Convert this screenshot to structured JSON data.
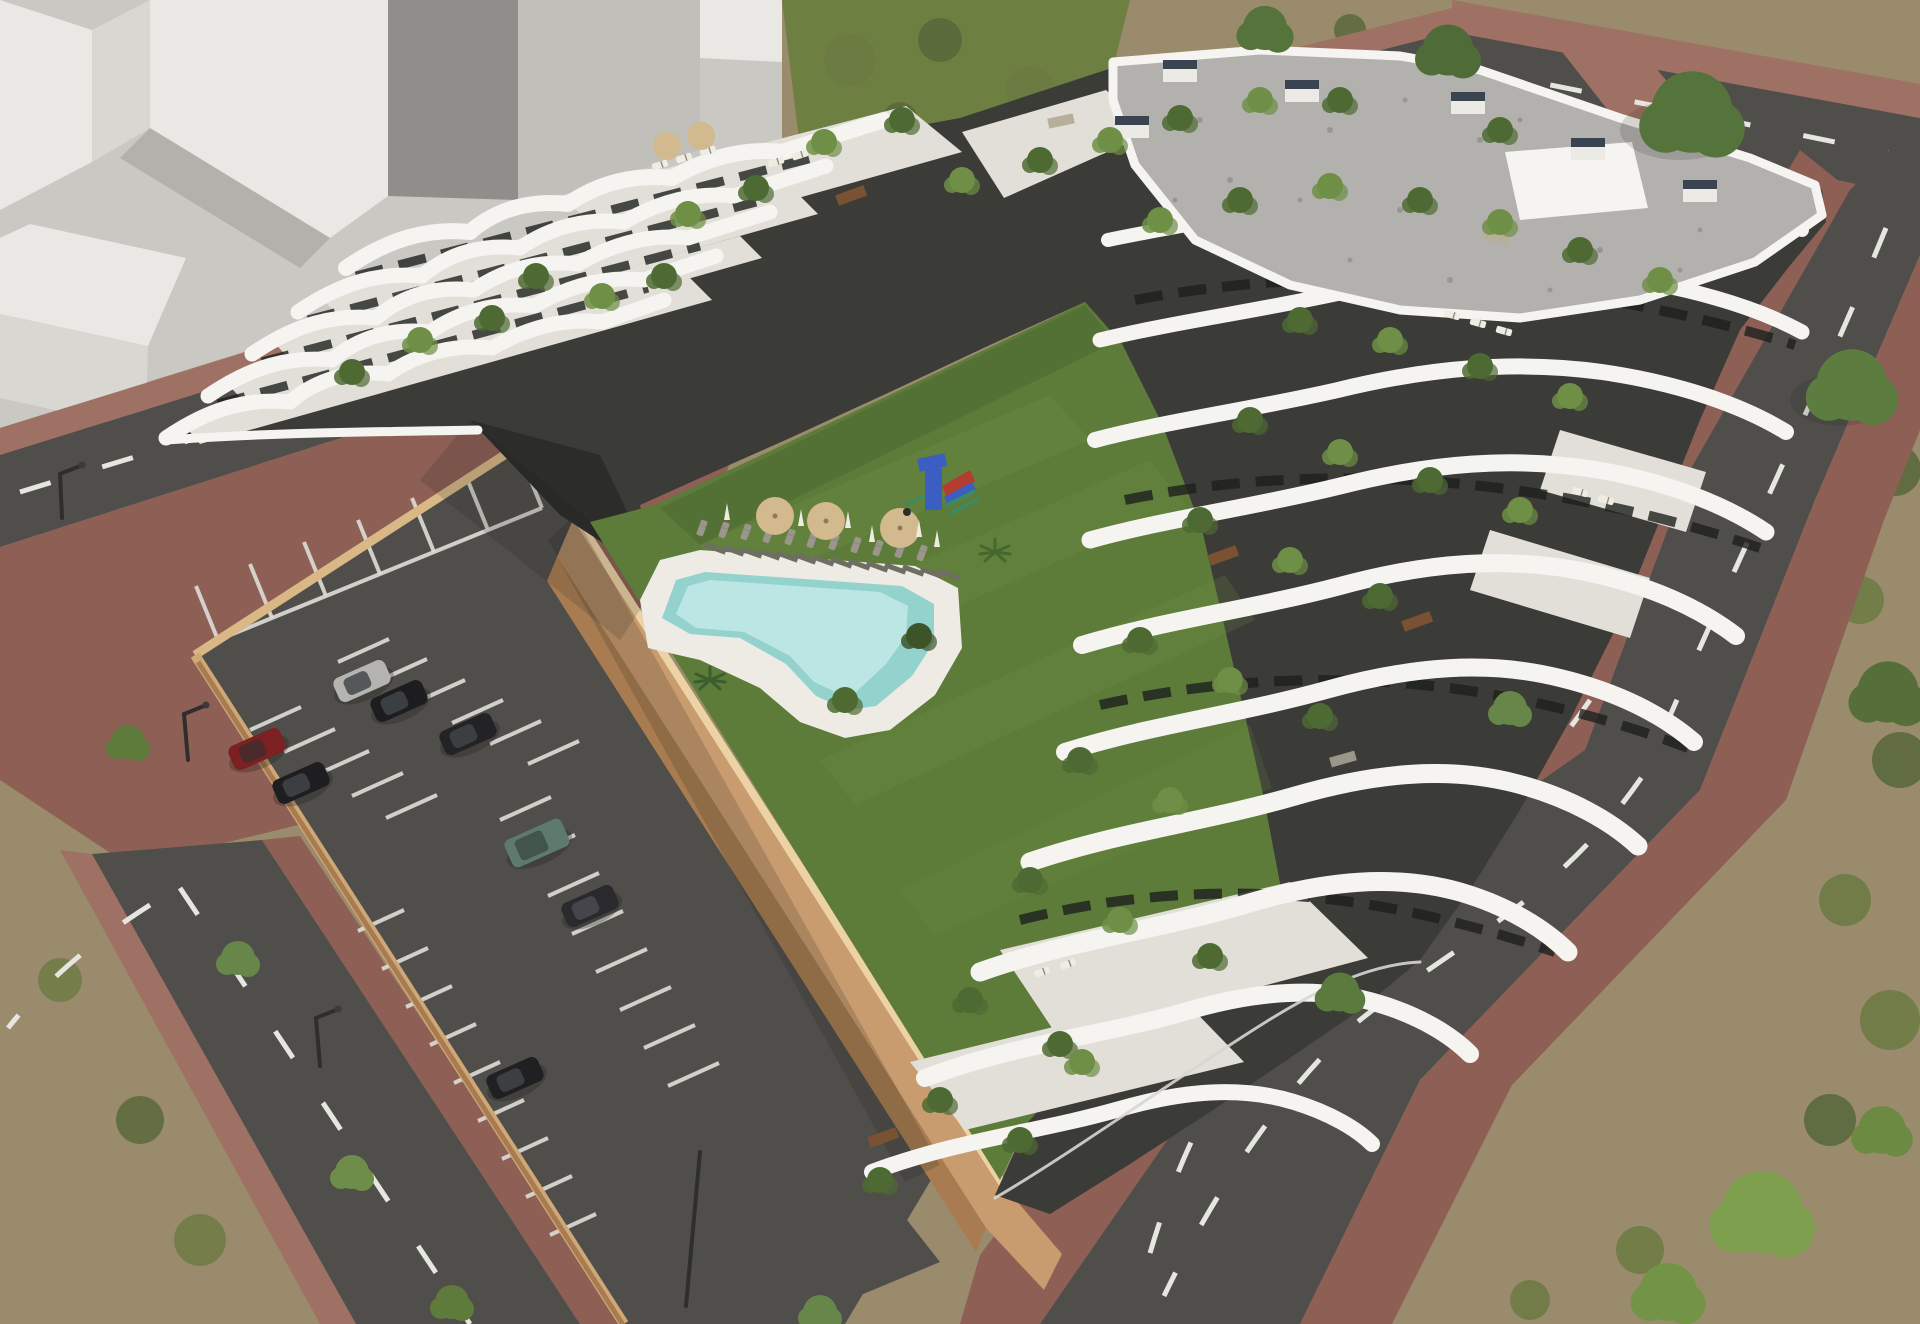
{
  "meta": {
    "kind": "architectural-aerial-render",
    "description": "Aerial 3D rendering of a new-build white terraced apartment complex with cascading planted balconies, a gravel flat roof, a central lawn courtyard with free-form swimming pool, sun loungers, parasols and a playground, an open-air parking lot with cars behind tan retaining walls, surrounded by asphalt streets with dashed white markings, red-brick paver sidewalks, street trees and unbuilt scrubland; abstract untextured white massing blocks occupy the upper-left context area.",
    "visible_text": ""
  },
  "palette": {
    "dirt": "#9a8b6c",
    "dirtLight": "#ab9c7d",
    "scrub": "#6b7a42",
    "scrubDark": "#57673a",
    "grassPatch": "#6d8041",
    "lawn": "#5d7c3a",
    "lawnLight": "#6f9045",
    "lawnShade": "#465f2d",
    "plane": "#cac8c3",
    "blockTop": "#e9e8e4",
    "blockSide": "#d8d7d2",
    "blockShadow": "#b2b1ac",
    "slab": "#c1bfba",
    "slabDark": "#8f8e8a",
    "road": "#504e4b",
    "dash": "#e6e6e1",
    "brick": "#8d5f55",
    "brickLight": "#9f7164",
    "white": "#f5f4f0",
    "floor": "#e2dfd8",
    "facade": "#3b3b38",
    "facadeDark": "#2c2c29",
    "glass": "#1e201e",
    "gravel": "#b2b1ad",
    "gravelDot": "#8d8c88",
    "ventTop": "#3a4450",
    "tanTop": "#ecd2a4",
    "tan": "#c89c6e",
    "tanDark": "#a87c50",
    "water": "#93d2cd",
    "waterLight": "#c6ebe8",
    "deck": "#edebe3",
    "plant": "#4e6a33",
    "plantLight": "#6f8f46",
    "plantDark": "#3d5429",
    "treeA": "#5b7a3e",
    "treeB": "#6b8a48",
    "treeBright": "#7fa04f",
    "wood": "#7a5233",
    "sofa": "#9a968c",
    "shadow": "#22221c",
    "railing": "#d8d6d0",
    "umbrellaTan": "#d2b98e",
    "parasol": "#efece2",
    "stall": "#deddd7",
    "pole": "#2e2e2c",
    "playBlue": "#3b5ec2",
    "playRed": "#b53c30",
    "playGreen": "#3d8a60"
  },
  "scene": {
    "context_massing": {
      "label": "abstract white context blocks",
      "count": 4
    },
    "streets": {
      "count": 3,
      "marking": "dashed white centerlines",
      "sidewalk": "red brick pavers",
      "crosswalk": "brick crossing at top-right"
    },
    "parking": {
      "surface": "dark asphalt with white stalls",
      "enclosure": "tan retaining walls",
      "cars": [
        {
          "label": "silver hatchback",
          "color": "#b6b4b0"
        },
        {
          "label": "black hatchback",
          "color": "#1d1d1f"
        },
        {
          "label": "black sedan",
          "color": "#232326"
        },
        {
          "label": "dark red hatchback",
          "color": "#7c2022"
        },
        {
          "label": "black car",
          "color": "#1e1e21"
        },
        {
          "label": "green SUV",
          "color": "#5e7a6d"
        },
        {
          "label": "dark gray sedan",
          "color": "#2a2a2e"
        },
        {
          "label": "dark car",
          "color": "#202023"
        }
      ]
    },
    "courtyard": {
      "lawn": "green mown lawn",
      "pool": "free-form turquoise pool with white deck",
      "pool_umbrellas": 3,
      "rooftop_umbrellas": 2,
      "sun_loungers": "rows beside boardwalk",
      "playground": {
        "tower": "#3b5ec2",
        "slide": "#b53c30",
        "frame": "#3d8a60"
      }
    },
    "building": {
      "style": "white organic terraced apartment block",
      "roof": "gray gravel flat roof with vent stacks and white parapet",
      "facade": "dark gray recessed walls with glazing behind wavy white balcony bands",
      "greenery": "potted shrubs and small trees on every terrace"
    },
    "vegetation": {
      "street_trees": 9,
      "large_trees_top_right": 4,
      "bushes_bottom_right": 3,
      "scrubland": "patchy grass over dirt"
    }
  }
}
